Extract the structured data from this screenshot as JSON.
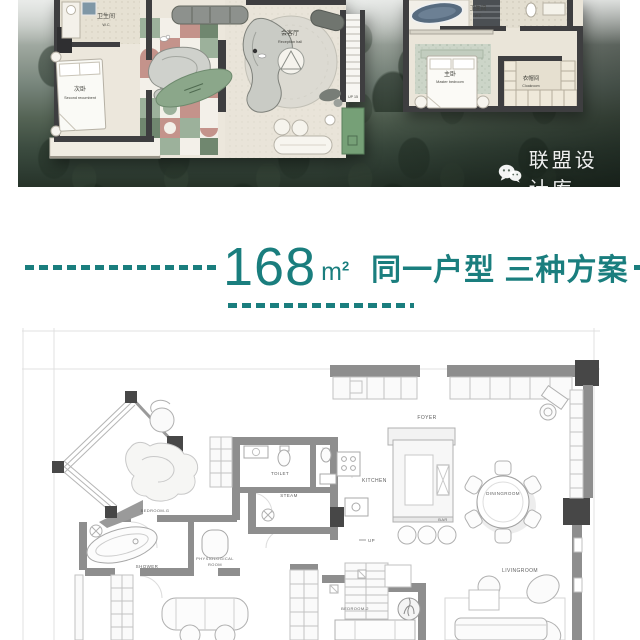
{
  "colors": {
    "accent_teal": "#1a7e7e",
    "planter_green": "#76a077",
    "rug_pink": "#c4938b",
    "rug_sage": "#9cb19b",
    "bathtub_blue": "#576b7f"
  },
  "hero": {
    "watermark": "联盟设计库",
    "plan_a": {
      "wc_zh": "卫生间",
      "wc_en": "W.C",
      "bedroom_zh": "次卧",
      "bedroom_en": "Second recumbent",
      "reception_zh": "会客厅",
      "reception_en": "Reception hall",
      "stairs": "UP 15"
    },
    "plan_b": {
      "wc_zh": "卫生间",
      "wc_en": "W.C",
      "master_zh": "主卧",
      "master_en": "Master bedroom",
      "cloak_zh": "衣帽间",
      "cloak_en": "Cloakroom"
    }
  },
  "title": {
    "number": "168",
    "unit_base": "m",
    "unit_sup": "2",
    "caption": "同一户型 三种方案"
  },
  "bottom_plan": {
    "labels": {
      "foyer": "FOYER",
      "kitchen": "KITCHEN",
      "bar": "BAR",
      "up": "UP",
      "dining": "DININGROOM",
      "living": "LIVINGROOM",
      "bedroom_g": "BEDROOM-G",
      "bedroom_2": "BEDROOM-2",
      "shower": "SHOWER",
      "physio_line1": "PHYSIOLOGICAL",
      "physio_line2": "ROOM",
      "toilet": "TOILET",
      "steam": "STEAM"
    }
  }
}
